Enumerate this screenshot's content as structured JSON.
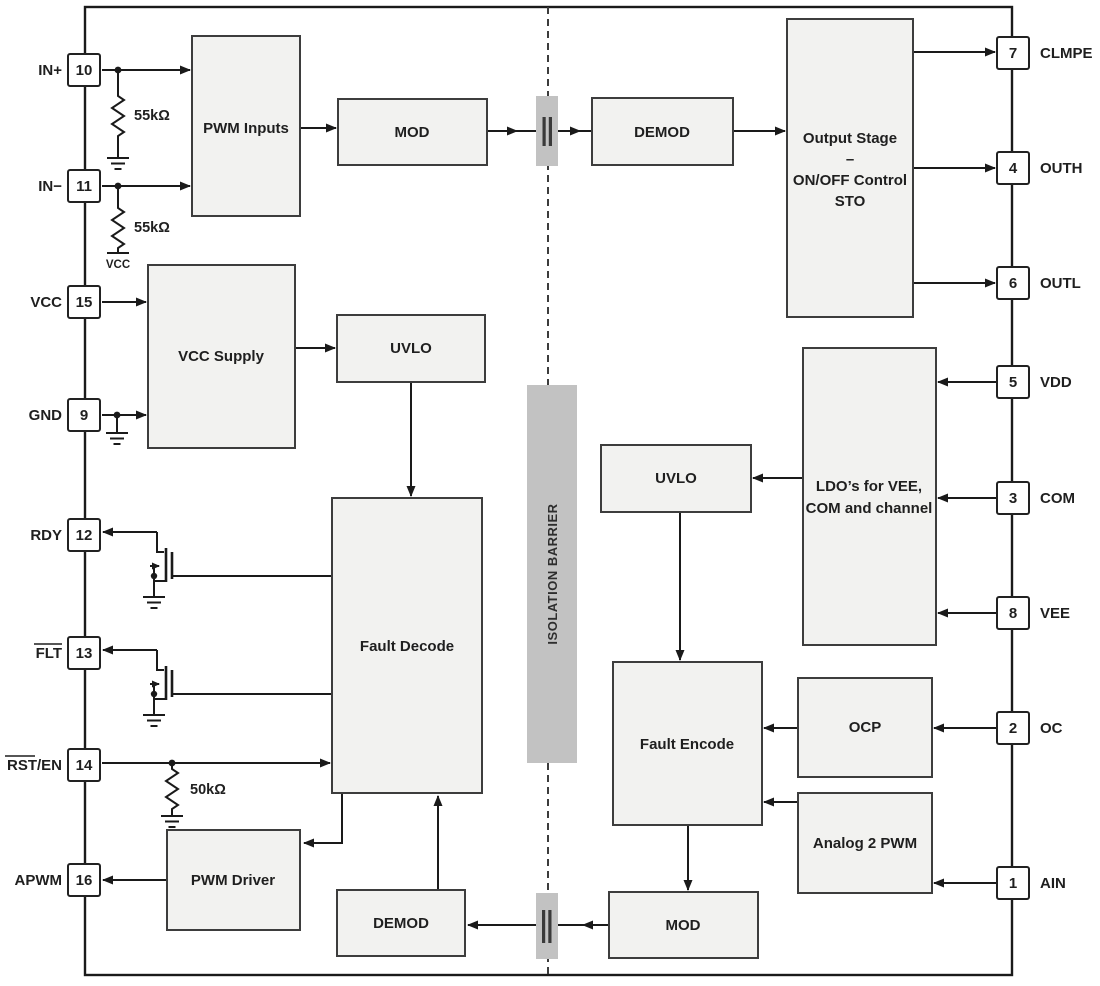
{
  "barrier": {
    "label": "ISOLATION BARRIER"
  },
  "blocks": {
    "pwm_inputs": {
      "label": "PWM Inputs"
    },
    "mod_top": {
      "label": "MOD"
    },
    "demod_top": {
      "label": "DEMOD"
    },
    "output_stage": {
      "line1": "Output Stage",
      "line2": "–",
      "line3": "ON/OFF Control",
      "line4": "STO"
    },
    "vcc_supply": {
      "label": "VCC Supply"
    },
    "uvlo_left": {
      "label": "UVLO"
    },
    "fault_decode": {
      "label": "Fault Decode"
    },
    "pwm_driver": {
      "label": "PWM Driver"
    },
    "demod_bottom": {
      "label": "DEMOD"
    },
    "mod_bottom": {
      "label": "MOD"
    },
    "uvlo_right": {
      "label": "UVLO"
    },
    "ldo": {
      "line1": "LDO’s for VEE,",
      "line2": "COM and channel"
    },
    "fault_encode": {
      "label": "Fault Encode"
    },
    "ocp": {
      "label": "OCP"
    },
    "analog2pwm": {
      "label": "Analog 2 PWM"
    }
  },
  "pins_left": [
    {
      "label": "IN+",
      "number": "10"
    },
    {
      "label": "IN−",
      "number": "11"
    },
    {
      "label": "VCC",
      "number": "15"
    },
    {
      "label": "GND",
      "number": "9"
    },
    {
      "label": "RDY",
      "number": "12"
    },
    {
      "label": "FLT",
      "number": "13"
    },
    {
      "label": "RST/EN",
      "number": "14"
    },
    {
      "label": "APWM",
      "number": "16"
    }
  ],
  "pins_right": [
    {
      "label": "CLMPE",
      "number": "7"
    },
    {
      "label": "OUTH",
      "number": "4"
    },
    {
      "label": "OUTL",
      "number": "6"
    },
    {
      "label": "VDD",
      "number": "5"
    },
    {
      "label": "COM",
      "number": "3"
    },
    {
      "label": "VEE",
      "number": "8"
    },
    {
      "label": "OC",
      "number": "2"
    },
    {
      "label": "AIN",
      "number": "1"
    }
  ],
  "resistors": [
    {
      "value": "55kΩ"
    },
    {
      "value": "55kΩ"
    },
    {
      "value": "50kΩ"
    }
  ],
  "rail": {
    "label": "VCC"
  },
  "colors": {
    "line": "#1a1a1a",
    "block_fill": "#f2f2f0",
    "block_stroke": "#3d3d3d",
    "barrier_fill": "#c2c2c2",
    "capacitor_plate": "#3a3a3a",
    "pin_fill": "#ffffff",
    "pin_stroke": "#222222",
    "text": "#1f1f1f"
  }
}
